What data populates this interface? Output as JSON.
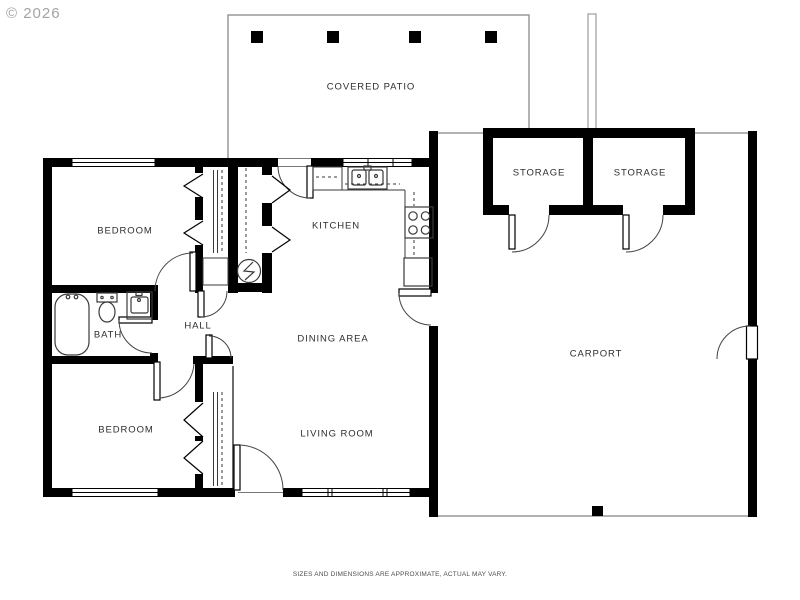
{
  "watermark": {
    "copyright": "© 2026"
  },
  "footer": {
    "disclaimer": "SIZES AND DIMENSIONS ARE APPROXIMATE, ACTUAL MAY VARY."
  },
  "rooms": [
    {
      "label": "COVERED PATIO",
      "x": 371,
      "y": 87
    },
    {
      "label": "STORAGE",
      "x": 539,
      "y": 173
    },
    {
      "label": "STORAGE",
      "x": 640,
      "y": 173
    },
    {
      "label": "KITCHEN",
      "x": 336,
      "y": 226
    },
    {
      "label": "BEDROOM",
      "x": 125,
      "y": 231
    },
    {
      "label": "BATH",
      "x": 108,
      "y": 335
    },
    {
      "label": "HALL",
      "x": 198,
      "y": 326
    },
    {
      "label": "DINING AREA",
      "x": 333,
      "y": 339
    },
    {
      "label": "LIVING ROOM",
      "x": 337,
      "y": 434
    },
    {
      "label": "BEDROOM",
      "x": 126,
      "y": 430
    },
    {
      "label": "CARPORT",
      "x": 596,
      "y": 354
    }
  ],
  "icons": [
    "bathtub-icon",
    "toilet-icon",
    "sink-vanity-icon",
    "kitchen-sink-icon",
    "stove-icon",
    "refrigerator-icon",
    "water-heater-icon",
    "door-swing-icon",
    "bifold-door-icon",
    "window-icon",
    "patio-post-icon"
  ],
  "colors": {
    "wall": "#000000",
    "thin_line": "#999999",
    "fixture_line": "#3a3a3a",
    "label_text": "#2e2e2e",
    "copyright_text": "#a3a3a3",
    "disclaimer_text": "#4d4d4d",
    "background": "#ffffff"
  }
}
